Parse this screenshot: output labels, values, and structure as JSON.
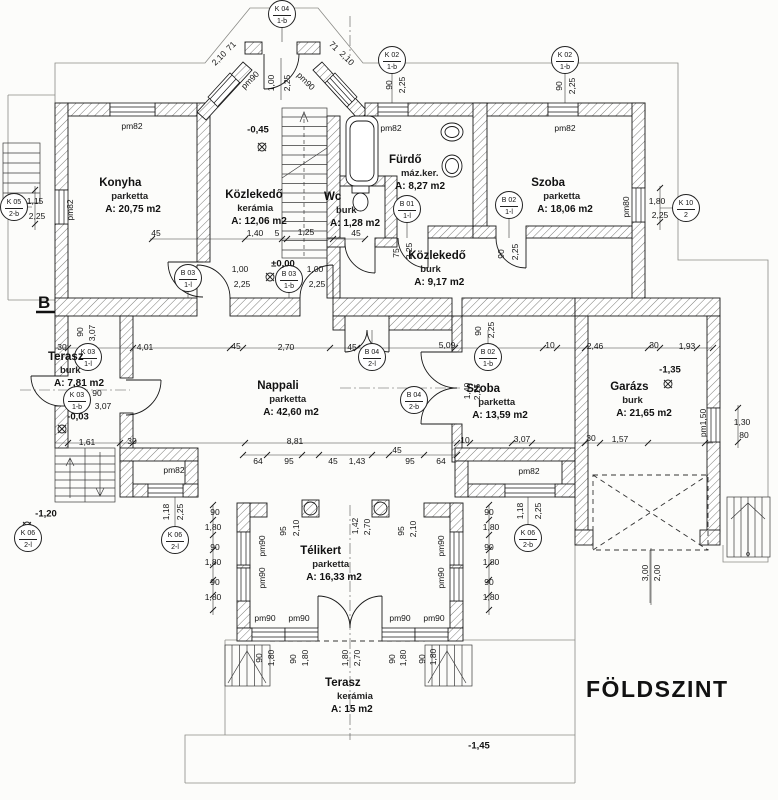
{
  "title": "FÖLDSZINT",
  "drawing": {
    "rooms": [
      {
        "name": "Konyha",
        "finish": "parketta",
        "area": "A: 20,75 m2",
        "x": 130,
        "y": 176
      },
      {
        "name": "Közlekedő",
        "finish": "kerámia",
        "area": "A: 12,06 m2",
        "x": 256,
        "y": 188
      },
      {
        "name": "Fürdő",
        "finish": "máz.ker.",
        "area": "A: 8,27 m2",
        "x": 417,
        "y": 153
      },
      {
        "name": "Wc",
        "finish": "burk",
        "area": "A: 1,28 m2",
        "x": 352,
        "y": 190
      },
      {
        "name": "Szoba",
        "finish": "parketta",
        "area": "A: 18,06 m2",
        "x": 562,
        "y": 176
      },
      {
        "name": "Közlekedő",
        "finish": "burk",
        "area": "A: 9,17 m2",
        "x": 437,
        "y": 249
      },
      {
        "name": "Nappali",
        "finish": "parketta",
        "area": "A: 42,60 m2",
        "x": 288,
        "y": 379
      },
      {
        "name": "Szoba",
        "finish": "parketta",
        "area": "A: 13,59 m2",
        "x": 497,
        "y": 382
      },
      {
        "name": "Garázs",
        "finish": "burk",
        "area": "A: 21,65 m2",
        "x": 641,
        "y": 380
      },
      {
        "name": "Terasz",
        "finish": "burk",
        "area": "A: 7,81 m2",
        "x": 76,
        "y": 350
      },
      {
        "name": "Télikert",
        "finish": "parketta",
        "area": "A: 16,33 m2",
        "x": 331,
        "y": 544
      },
      {
        "name": "Terasz",
        "finish": "kerámia",
        "area": "A: 15 m2",
        "x": 349,
        "y": 676
      }
    ],
    "tags": [
      {
        "l1": "K 04",
        "l2": "1-b",
        "x": 282,
        "y": 14
      },
      {
        "l1": "K 02",
        "l2": "1-b",
        "x": 392,
        "y": 60
      },
      {
        "l1": "K 02",
        "l2": "1-b",
        "x": 565,
        "y": 60
      },
      {
        "l1": "K 05",
        "l2": "2-b",
        "x": 14,
        "y": 207
      },
      {
        "l1": "K 10",
        "l2": "2",
        "x": 686,
        "y": 208
      },
      {
        "l1": "K 03",
        "l2": "1-l",
        "x": 88,
        "y": 357
      },
      {
        "l1": "K 03",
        "l2": "1-b",
        "x": 77,
        "y": 400
      },
      {
        "l1": "B 03",
        "l2": "1-l",
        "x": 188,
        "y": 278
      },
      {
        "l1": "B 03",
        "l2": "1-b",
        "x": 289,
        "y": 279
      },
      {
        "l1": "B 01",
        "l2": "1-l",
        "x": 407,
        "y": 209
      },
      {
        "l1": "B 02",
        "l2": "1-l",
        "x": 509,
        "y": 205
      },
      {
        "l1": "B 02",
        "l2": "1-b",
        "x": 488,
        "y": 357
      },
      {
        "l1": "B 04",
        "l2": "2-l",
        "x": 372,
        "y": 357
      },
      {
        "l1": "B 04",
        "l2": "2-b",
        "x": 414,
        "y": 400
      },
      {
        "l1": "K 06",
        "l2": "2-l",
        "x": 175,
        "y": 540
      },
      {
        "l1": "K 06",
        "l2": "2-b",
        "x": 528,
        "y": 538
      },
      {
        "l1": "K 06",
        "l2": "2-l",
        "x": 28,
        "y": 538
      }
    ],
    "levels": [
      {
        "text": "-0,45",
        "x": 258,
        "y": 130
      },
      {
        "text": "±0,00",
        "x": 283,
        "y": 264
      },
      {
        "text": "-0,03",
        "x": 78,
        "y": 417
      },
      {
        "text": "-1,20",
        "x": 46,
        "y": 514
      },
      {
        "text": "-1,35",
        "x": 670,
        "y": 370
      },
      {
        "text": "-1,45",
        "x": 479,
        "y": 746
      }
    ],
    "section_label": {
      "text": "B",
      "x": 38,
      "y": 293
    },
    "dims": [
      {
        "t": "1,00",
        "x": 271,
        "y": 83,
        "r": -90
      },
      {
        "t": "2,25",
        "x": 287,
        "y": 83,
        "r": -90
      },
      {
        "t": "71",
        "x": 231,
        "y": 46,
        "r": -45
      },
      {
        "t": "2,10",
        "x": 219,
        "y": 58,
        "r": -45
      },
      {
        "t": "71",
        "x": 334,
        "y": 46,
        "r": 45
      },
      {
        "t": "2,10",
        "x": 347,
        "y": 58,
        "r": 45
      },
      {
        "t": "pm90",
        "x": 250,
        "y": 80,
        "r": -45
      },
      {
        "t": "pm90",
        "x": 306,
        "y": 81,
        "r": 45
      },
      {
        "t": "90",
        "x": 389,
        "y": 85,
        "r": -90
      },
      {
        "t": "2,25",
        "x": 402,
        "y": 85,
        "r": -90
      },
      {
        "t": "pm82",
        "x": 391,
        "y": 128
      },
      {
        "t": "90",
        "x": 559,
        "y": 86,
        "r": -90
      },
      {
        "t": "2,25",
        "x": 572,
        "y": 86,
        "r": -90
      },
      {
        "t": "pm82",
        "x": 565,
        "y": 128
      },
      {
        "t": "pm82",
        "x": 132,
        "y": 126
      },
      {
        "t": "1,15",
        "x": 35,
        "y": 201
      },
      {
        "t": "2,25",
        "x": 37,
        "y": 216
      },
      {
        "t": "pm82",
        "x": 70,
        "y": 210,
        "r": -90
      },
      {
        "t": "1,80",
        "x": 657,
        "y": 201
      },
      {
        "t": "2,25",
        "x": 660,
        "y": 215
      },
      {
        "t": "pm80",
        "x": 626,
        "y": 207,
        "r": -90
      },
      {
        "t": "45",
        "x": 156,
        "y": 233
      },
      {
        "t": "1,40",
        "x": 255,
        "y": 233
      },
      {
        "t": "5",
        "x": 277,
        "y": 233
      },
      {
        "t": "1,25",
        "x": 306,
        "y": 232
      },
      {
        "t": "45",
        "x": 356,
        "y": 233
      },
      {
        "t": "1,00",
        "x": 240,
        "y": 269
      },
      {
        "t": "2,25",
        "x": 242,
        "y": 284
      },
      {
        "t": "1,00",
        "x": 315,
        "y": 269
      },
      {
        "t": "2,25",
        "x": 317,
        "y": 284
      },
      {
        "t": "75",
        "x": 396,
        "y": 253,
        "r": -90
      },
      {
        "t": "2,25",
        "x": 409,
        "y": 251,
        "r": -90
      },
      {
        "t": "90",
        "x": 501,
        "y": 254,
        "r": -90
      },
      {
        "t": "2,25",
        "x": 515,
        "y": 252,
        "r": -90
      },
      {
        "t": "4,01",
        "x": 145,
        "y": 347
      },
      {
        "t": "45",
        "x": 236,
        "y": 346
      },
      {
        "t": "2,70",
        "x": 286,
        "y": 347
      },
      {
        "t": "45",
        "x": 352,
        "y": 347
      },
      {
        "t": "5,09",
        "x": 447,
        "y": 345
      },
      {
        "t": "10",
        "x": 550,
        "y": 345
      },
      {
        "t": "2,46",
        "x": 595,
        "y": 346
      },
      {
        "t": "30",
        "x": 654,
        "y": 345
      },
      {
        "t": "1,93",
        "x": 687,
        "y": 346
      },
      {
        "t": "30",
        "x": 62,
        "y": 347
      },
      {
        "t": "90",
        "x": 80,
        "y": 332,
        "r": -90
      },
      {
        "t": "3,07",
        "x": 92,
        "y": 333,
        "r": -90
      },
      {
        "t": "90",
        "x": 97,
        "y": 393
      },
      {
        "t": "3,07",
        "x": 103,
        "y": 406
      },
      {
        "t": "1,61",
        "x": 87,
        "y": 442
      },
      {
        "t": "30",
        "x": 132,
        "y": 441
      },
      {
        "t": "8,81",
        "x": 295,
        "y": 441
      },
      {
        "t": "10",
        "x": 465,
        "y": 440
      },
      {
        "t": "3,07",
        "x": 522,
        "y": 439
      },
      {
        "t": "30",
        "x": 591,
        "y": 438
      },
      {
        "t": "1,57",
        "x": 620,
        "y": 439
      },
      {
        "t": "90",
        "x": 478,
        "y": 331,
        "r": -90
      },
      {
        "t": "2,25",
        "x": 491,
        "y": 330,
        "r": -90
      },
      {
        "t": "1,40",
        "x": 467,
        "y": 391,
        "r": -90
      },
      {
        "t": "2,25",
        "x": 477,
        "y": 392,
        "r": -90
      },
      {
        "t": "64",
        "x": 258,
        "y": 461
      },
      {
        "t": "95",
        "x": 289,
        "y": 461
      },
      {
        "t": "45",
        "x": 333,
        "y": 461
      },
      {
        "t": "1,43",
        "x": 357,
        "y": 461
      },
      {
        "t": "45",
        "x": 397,
        "y": 450
      },
      {
        "t": "95",
        "x": 410,
        "y": 461
      },
      {
        "t": "64",
        "x": 441,
        "y": 461
      },
      {
        "t": "pm82",
        "x": 174,
        "y": 470
      },
      {
        "t": "pm82",
        "x": 529,
        "y": 471
      },
      {
        "t": "1,18",
        "x": 166,
        "y": 512,
        "r": -90
      },
      {
        "t": "2,25",
        "x": 180,
        "y": 512,
        "r": -90
      },
      {
        "t": "1,18",
        "x": 520,
        "y": 511,
        "r": -90
      },
      {
        "t": "2,25",
        "x": 538,
        "y": 511,
        "r": -90
      },
      {
        "t": "90",
        "x": 215,
        "y": 512
      },
      {
        "t": "1,80",
        "x": 213,
        "y": 527
      },
      {
        "t": "90",
        "x": 215,
        "y": 547
      },
      {
        "t": "1,80",
        "x": 213,
        "y": 562
      },
      {
        "t": "90",
        "x": 215,
        "y": 582
      },
      {
        "t": "1,80",
        "x": 213,
        "y": 597
      },
      {
        "t": "90",
        "x": 489,
        "y": 512
      },
      {
        "t": "1,80",
        "x": 491,
        "y": 527
      },
      {
        "t": "90",
        "x": 489,
        "y": 547
      },
      {
        "t": "1,80",
        "x": 491,
        "y": 562
      },
      {
        "t": "90",
        "x": 489,
        "y": 582
      },
      {
        "t": "1,80",
        "x": 491,
        "y": 597
      },
      {
        "t": "95",
        "x": 283,
        "y": 531,
        "r": -90
      },
      {
        "t": "2,10",
        "x": 296,
        "y": 528,
        "r": -90
      },
      {
        "t": "1,42",
        "x": 355,
        "y": 526,
        "r": -90
      },
      {
        "t": "2,70",
        "x": 367,
        "y": 527,
        "r": -90
      },
      {
        "t": "95",
        "x": 401,
        "y": 531,
        "r": -90
      },
      {
        "t": "2,10",
        "x": 413,
        "y": 529,
        "r": -90
      },
      {
        "t": "pm90",
        "x": 262,
        "y": 546,
        "r": -90
      },
      {
        "t": "pm90",
        "x": 262,
        "y": 578,
        "r": -90
      },
      {
        "t": "pm90",
        "x": 441,
        "y": 546,
        "r": -90
      },
      {
        "t": "pm90",
        "x": 441,
        "y": 578,
        "r": -90
      },
      {
        "t": "pm90",
        "x": 265,
        "y": 618
      },
      {
        "t": "pm90",
        "x": 299,
        "y": 618
      },
      {
        "t": "pm90",
        "x": 400,
        "y": 618
      },
      {
        "t": "pm90",
        "x": 434,
        "y": 618
      },
      {
        "t": "90",
        "x": 259,
        "y": 658,
        "r": -90
      },
      {
        "t": "1,80",
        "x": 271,
        "y": 658,
        "r": -90
      },
      {
        "t": "90",
        "x": 293,
        "y": 659,
        "r": -90
      },
      {
        "t": "1,80",
        "x": 305,
        "y": 658,
        "r": -90
      },
      {
        "t": "1,80",
        "x": 345,
        "y": 658,
        "r": -90
      },
      {
        "t": "2,70",
        "x": 357,
        "y": 658,
        "r": -90
      },
      {
        "t": "90",
        "x": 392,
        "y": 659,
        "r": -90
      },
      {
        "t": "1,80",
        "x": 403,
        "y": 658,
        "r": -90
      },
      {
        "t": "90",
        "x": 422,
        "y": 659,
        "r": -90
      },
      {
        "t": "1,80",
        "x": 433,
        "y": 657,
        "r": -90
      },
      {
        "t": "3,00",
        "x": 645,
        "y": 573,
        "r": -90
      },
      {
        "t": "2,00",
        "x": 657,
        "y": 573,
        "r": -90
      },
      {
        "t": "pm1,50",
        "x": 703,
        "y": 423,
        "r": -90
      },
      {
        "t": "1,30",
        "x": 742,
        "y": 422
      },
      {
        "t": "80",
        "x": 744,
        "y": 435
      }
    ]
  }
}
